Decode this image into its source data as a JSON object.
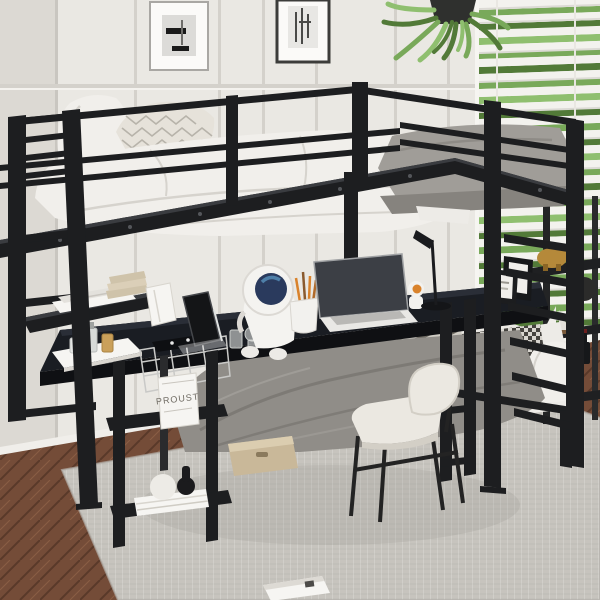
{
  "meta": {
    "description": "Product photograph of a black metal twin loft bed with built-in long desk, storage shelves, ladder, lower full bed, desk accessories and a chair in a bright bedroom",
    "image_type": "product-photo",
    "width": 600,
    "height": 600
  },
  "text": {
    "book_cover": "PROUST"
  },
  "palette": {
    "wall": "#eae8e3",
    "wall_left": "#dcd9d3",
    "wall_line": "#d4d1cb",
    "frame_black": "#1d1e20",
    "frame_hi": "#3a3c40",
    "bedding": "#f1efeb",
    "bedding_sh": "#d6d3cd",
    "knit": "#e6e2da",
    "knit_line": "#b7b3aa",
    "mattress": "#a09d98",
    "mattress_dk": "#86837e",
    "blanket": "#908d88",
    "blanket_dk": "#787570",
    "sheet": "#edebe7",
    "desk": "#1a1d23",
    "desk_hi": "#2a2e37",
    "desk_edge": "#0f1013",
    "rug": "#c7c4be",
    "rug_dk": "#b4b1ab",
    "wood": "#744c38",
    "wood_dk": "#593929",
    "wood_hi": "#8a5d44",
    "blind": "#f3f2ee",
    "blind_sh": "#dcdad5",
    "green1": "#79a95a",
    "green2": "#527a38",
    "green3": "#8fbf6f",
    "chair_seat": "#ebe8e1",
    "chair_sh": "#d3cfc6",
    "gold": "#b5893a",
    "gold_dk": "#8a6526",
    "visor": "#2a3a5d",
    "visor_hi": "#4e7fa8",
    "orange": "#d9822b",
    "paper": "#f6f5f2",
    "book_beige": "#cfc3aa",
    "box": "#c9b899",
    "box_hi": "#dbcdb0",
    "hound_dk": "#45433f",
    "stripe_dk": "#6e6a62",
    "metal_wire": "#c9c9c7"
  },
  "scene": {
    "room": [
      "paneled-wall",
      "window-blinds-with-greenery",
      "herringbone-wood-floor",
      "gray-area-rug",
      "baseboard"
    ],
    "wall_decor": [
      {
        "id": "picture-frame-left",
        "label": "abstract art print, white frame"
      },
      {
        "id": "picture-frame-right",
        "label": "sketch art print, black frame"
      },
      {
        "id": "hanging-plant",
        "label": "green hanging fern in dark pot"
      },
      {
        "id": "wall-ornament",
        "label": "small round dark ornament near window"
      }
    ],
    "furniture": [
      {
        "id": "loft-bed",
        "label": "black metal loft bed with guardrails, right ladder and left ladder"
      },
      {
        "id": "upper-bed",
        "items": [
          "white-pillow",
          "knit-pillow",
          "white-duvet",
          "gray-mattress"
        ]
      },
      {
        "id": "built-in-desk",
        "label": "long black desk under loft"
      },
      {
        "id": "under-desk-shelves",
        "label": "black storage shelf tower"
      },
      {
        "id": "hutch-shelf",
        "label": "raised shelf over left desk end"
      },
      {
        "id": "lower-bed",
        "items": [
          "gray-blanket",
          "houndstooth-pillow",
          "striped-pillow",
          "white-pillow"
        ]
      },
      {
        "id": "chair",
        "label": "cream upholstered chair with black metal legs"
      },
      {
        "id": "etagere",
        "label": "dark display shelf by window"
      },
      {
        "id": "storage-box",
        "label": "beige fabric under-bed storage box"
      }
    ],
    "desk_items": [
      "smartphone-on-stand",
      "astronaut-figurine",
      "pen-cup-with-pencils",
      "laptop",
      "mini-astronaut",
      "desk-lamp",
      "two-photo-frames",
      "power-strip",
      "perfume-tray",
      "wire-basket",
      "glass-bottles"
    ],
    "shelf_items": [
      "magazines",
      "beige-book-stack",
      "standing-book-proust",
      "white-sphere-ornament",
      "black-baluster-ornament",
      "stacked-books"
    ],
    "etagere_items": [
      "gold-elephant-figurine",
      "sailboat-model",
      "wine-bottle"
    ],
    "floor_items": [
      "open-white-book-on-rug"
    ]
  }
}
